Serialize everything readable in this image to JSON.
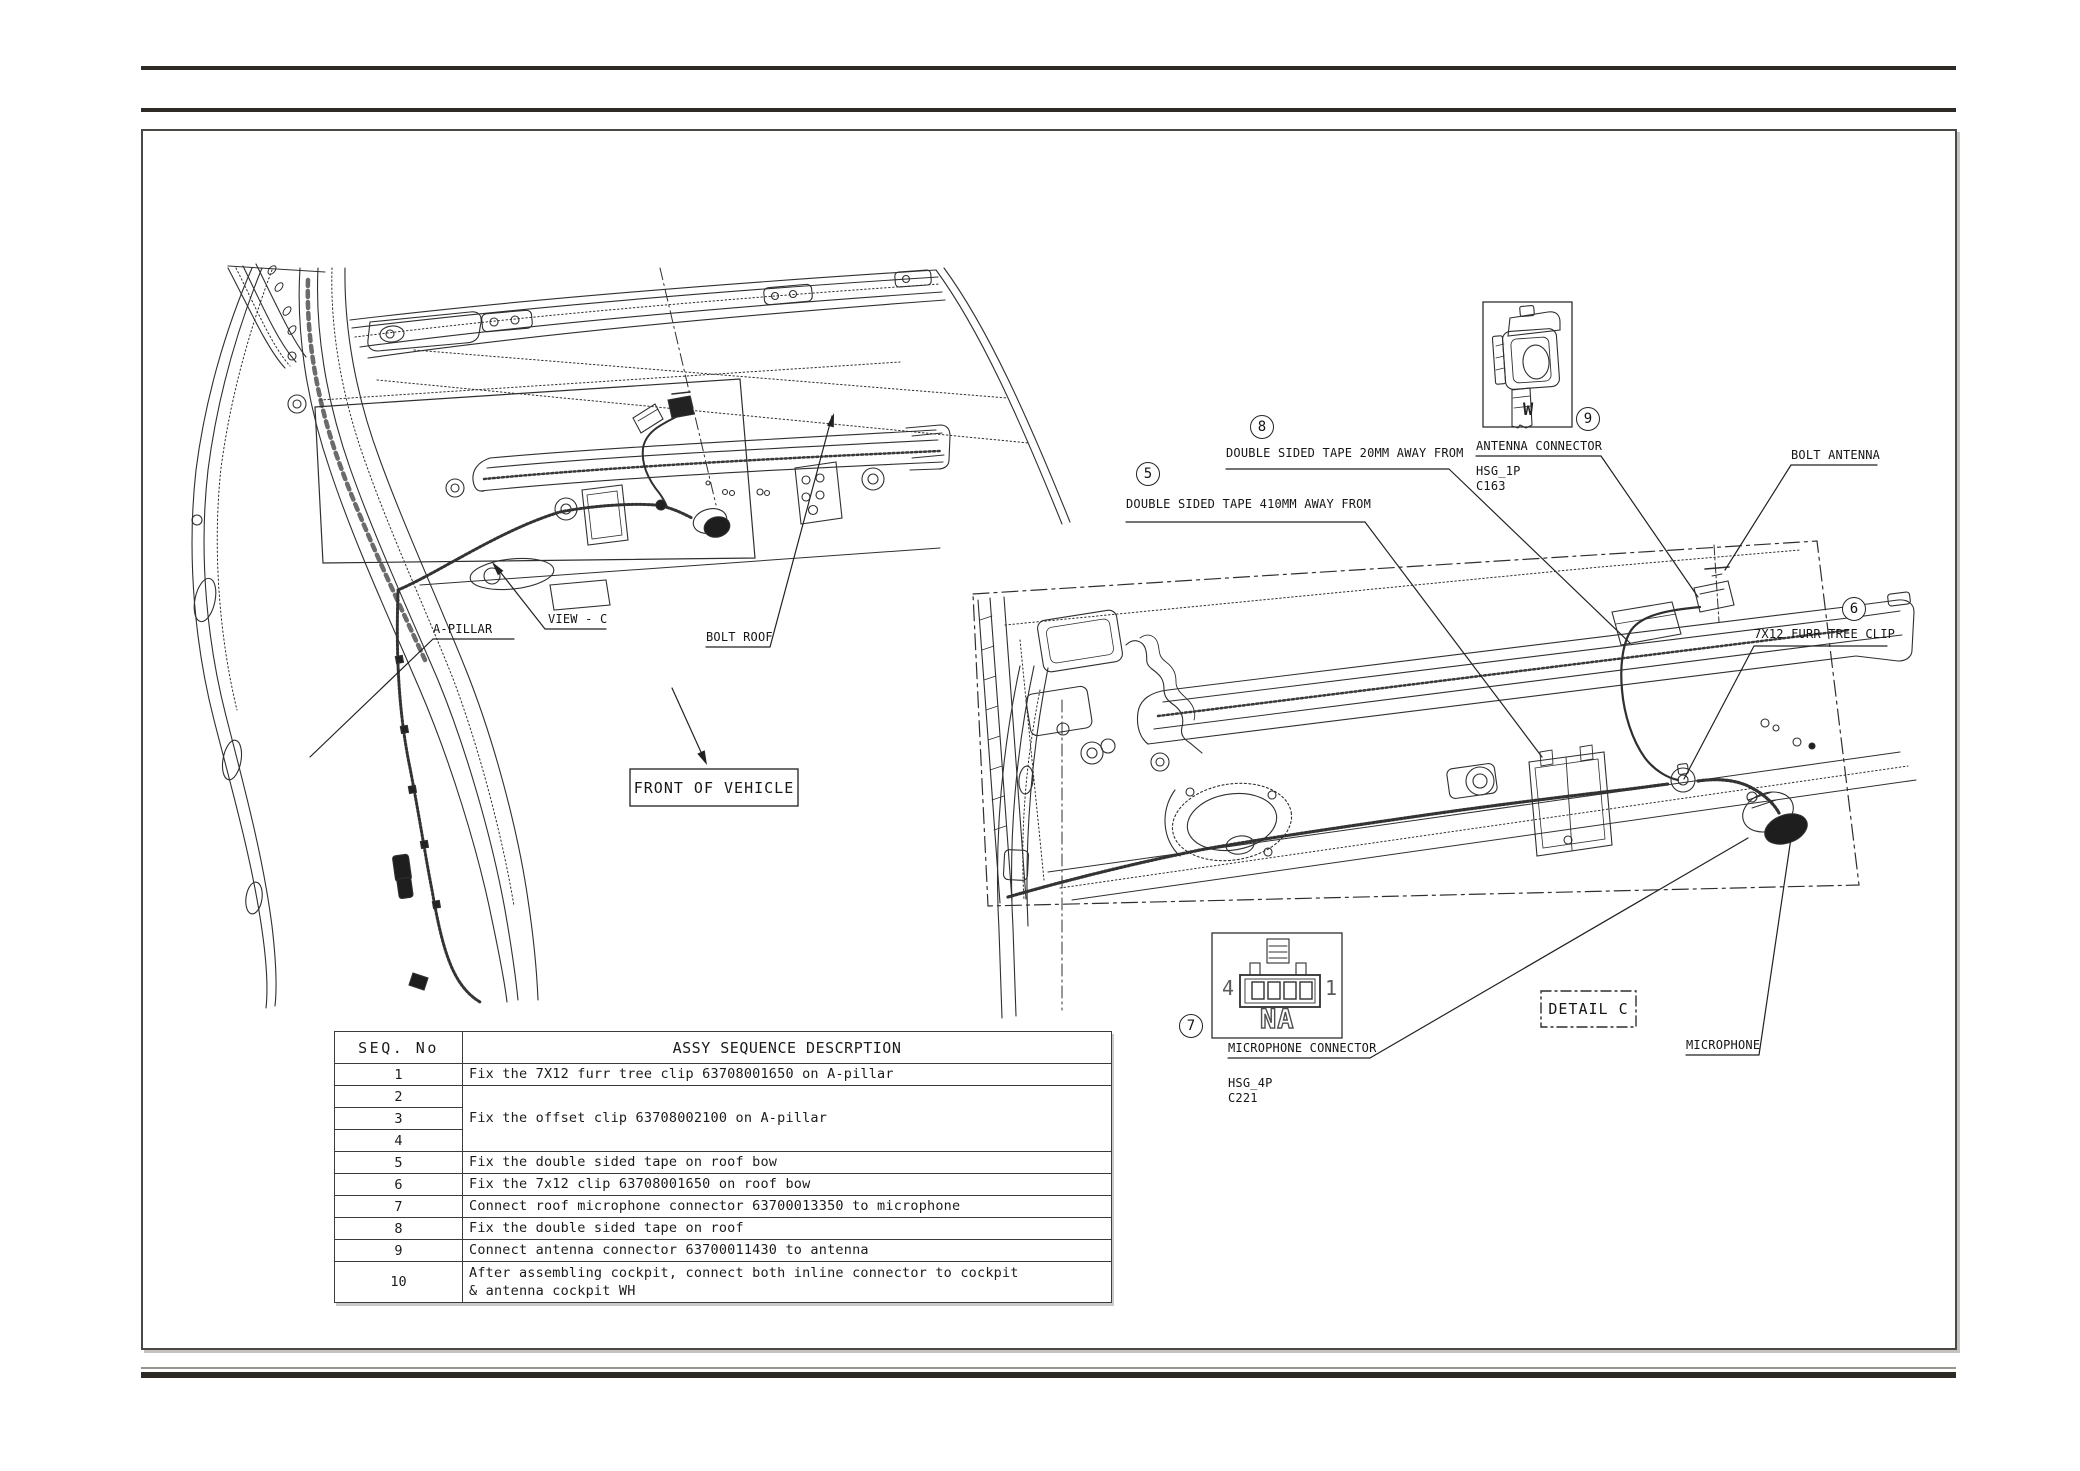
{
  "sheet": {
    "background": "#ffffff",
    "line_color": "#2f2f2f"
  },
  "table": {
    "header_seq": "SEQ. No",
    "header_desc": "ASSY SEQUENCE DESCRPTION",
    "rows": [
      {
        "seq": "1",
        "desc": "Fix the 7X12 furr tree clip 63708001650 on A-pillar"
      },
      {
        "seq": "2",
        "desc": "Fix the offset clip 63708002100 on A-pillar"
      },
      {
        "seq": "3",
        "desc": ""
      },
      {
        "seq": "4",
        "desc": ""
      },
      {
        "seq": "5",
        "desc": "Fix the double sided tape on roof bow"
      },
      {
        "seq": "6",
        "desc": "Fix the 7x12 clip 63708001650 on roof bow"
      },
      {
        "seq": "7",
        "desc": "Connect roof microphone connector 63700013350 to microphone"
      },
      {
        "seq": "8",
        "desc": "Fix the double sided tape on roof"
      },
      {
        "seq": "9",
        "desc": "Connect antenna connector 63700011430 to antenna"
      },
      {
        "seq": "10",
        "desc": "After assembling cockpit, connect both inline connector to cockpit\n& antenna cockpit WH"
      }
    ]
  },
  "labels": {
    "a_pillar": "A-PILLAR",
    "view_c": "VIEW - C",
    "bolt_roof": "BOLT ROOF",
    "front_of_vehicle": "FRONT OF VEHICLE",
    "tape_410": "DOUBLE SIDED TAPE 410MM AWAY FROM",
    "tape_20": "DOUBLE SIDED TAPE 20MM AWAY FROM",
    "antenna_connector": "ANTENNA CONNECTOR",
    "hsg_1p": "HSG_1P",
    "c163": "C163",
    "bolt_antenna": "BOLT ANTENNA",
    "furr_tree_clip": "7X12 FURR TREE CLIP",
    "microphone_connector": "MICROPHONE CONNECTOR",
    "hsg_4p": "HSG_4P",
    "c221": "C221",
    "detail_c": "DETAIL C",
    "microphone": "MICROPHONE"
  },
  "balloons": {
    "tape_410": "5",
    "clip_7x12": "6",
    "mic_connector": "7",
    "tape_20": "8",
    "antenna_connector": "9"
  },
  "connectors": {
    "antenna": {
      "code": "W",
      "housing": "HSG_1P",
      "circuit": "C163"
    },
    "microphone": {
      "pin_left": "4",
      "pin_right": "1",
      "code": "NA",
      "housing": "HSG_4P",
      "circuit": "C221"
    }
  }
}
